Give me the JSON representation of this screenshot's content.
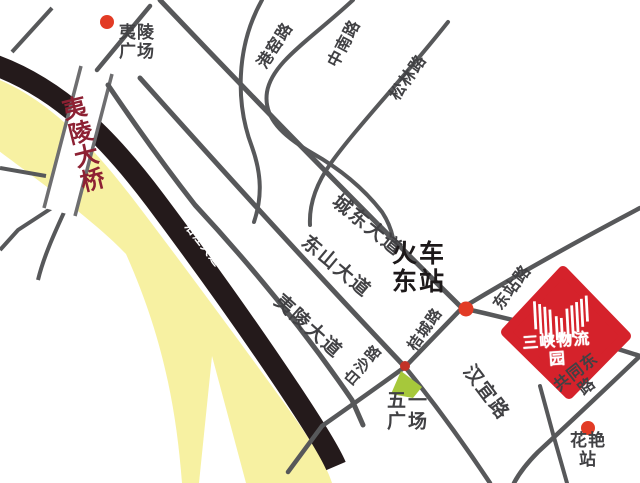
{
  "map": {
    "colors": {
      "river": "#F7F1A2",
      "riverside_road": "#241A1B",
      "road": "#57585A",
      "bridge_edge": "#6E6E70",
      "label": "#414144",
      "station_text": "#1D191A",
      "bridge_label": "#8D2133",
      "station_dot": "#E23B25",
      "junction_dot": "#C23227",
      "plaza_green": "#A6C83B",
      "logo_red": "#D5222B",
      "logo_text": "#FFFFFF"
    },
    "labels": {
      "yiling_square": {
        "text": "夷陵\n广场"
      },
      "yiling_bridge": {
        "text": "夷\n陵\n大\n桥"
      },
      "yanjiang_avenue": {
        "text": "沿江大道"
      },
      "gangyao_road": {
        "text": "港窑路"
      },
      "zhongnan_road": {
        "text": "中南路"
      },
      "songlin_road": {
        "text": "松林路"
      },
      "chengdong_avenue": {
        "text": "城东大道"
      },
      "dongshan_avenue": {
        "text": "东山大道"
      },
      "yiling_avenue": {
        "text": "夷陵大道"
      },
      "jucheng_road": {
        "text": "桔城路"
      },
      "baisha_road": {
        "text": "白沙路"
      },
      "dongzhan_road": {
        "text": "东站路"
      },
      "hanyi_road": {
        "text": "汉宜路"
      },
      "gongtong_east_road": {
        "text": "共同东路"
      },
      "train_east_station": {
        "text": "火车\n东站"
      },
      "wuyi_square": {
        "text": "五一\n广场"
      },
      "huayan_station": {
        "text": "花艳站"
      }
    },
    "logo": {
      "name": "三峡物流园"
    }
  }
}
